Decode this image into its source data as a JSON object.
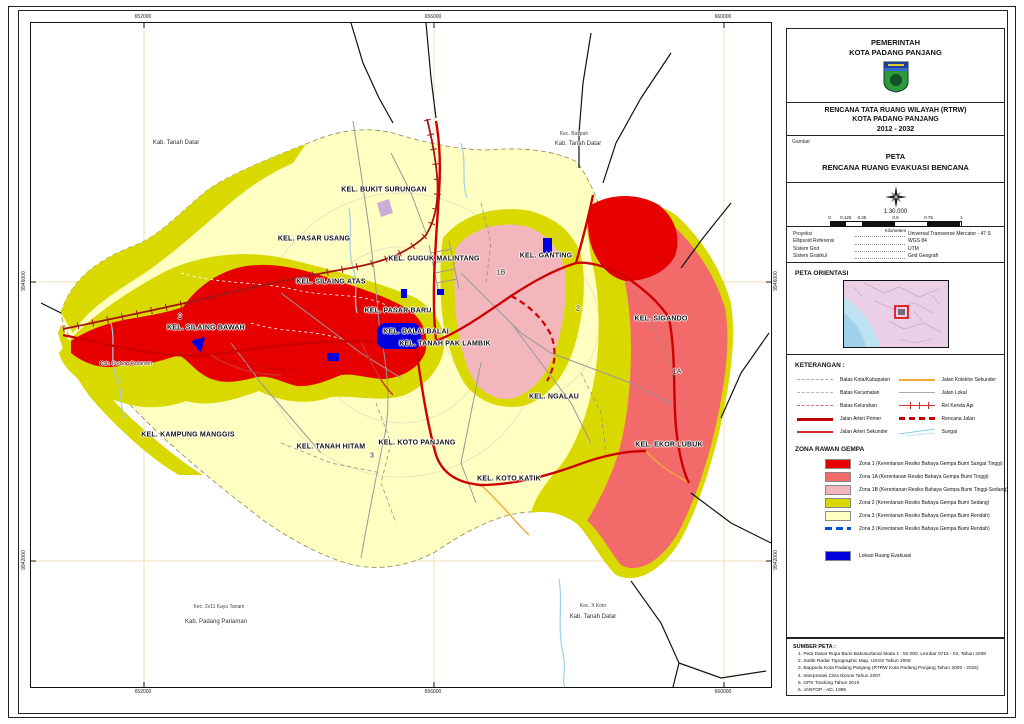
{
  "colors": {
    "zona1": "#e60000",
    "zona1a": "#f26a6a",
    "zona1b": "#f3b6bc",
    "zona2": "#d9d900",
    "zona3": "#ffffc2",
    "evakuasi": "#0000dd",
    "road_primary": "#cf0000",
    "rail": "#a51414",
    "water": "#9fd0e8",
    "grid_line": "#f2ddb5"
  },
  "map": {
    "labels": [
      {
        "t": "Kab. Tanah Datar",
        "x": 145,
        "y": 120,
        "cls": "sm"
      },
      {
        "t": "Kec. Batipuh",
        "x": 543,
        "y": 111,
        "cls": "xs"
      },
      {
        "t": "Kab. Tanah Datar",
        "x": 547,
        "y": 121,
        "cls": "sm"
      },
      {
        "t": "KEL. BUKIT SURUNGAN",
        "x": 353,
        "y": 167,
        "cls": "kel"
      },
      {
        "t": "KEL. PASAR USANG",
        "x": 283,
        "y": 216,
        "cls": "kel"
      },
      {
        "t": "KEL. GUGUK MALINTANG",
        "x": 403,
        "y": 236,
        "cls": "kel"
      },
      {
        "t": "KEL. GANTING",
        "x": 515,
        "y": 233,
        "cls": "kel"
      },
      {
        "t": "1B",
        "x": 470,
        "y": 250,
        "cls": "zn"
      },
      {
        "t": "KEL. SILAING ATAS",
        "x": 300,
        "y": 259,
        "cls": "kel"
      },
      {
        "t": "KEL. PASAR BARU",
        "x": 367,
        "y": 288,
        "cls": "kel"
      },
      {
        "t": "2",
        "x": 547,
        "y": 286,
        "cls": "zn"
      },
      {
        "t": "2",
        "x": 149,
        "y": 294,
        "cls": "zn"
      },
      {
        "t": "KEL. SILAING BAWAH",
        "x": 175,
        "y": 305,
        "cls": "kel"
      },
      {
        "t": "KEL. BALAI BALAI",
        "x": 385,
        "y": 309,
        "cls": "kel"
      },
      {
        "t": "KEL. TANAH PAK LAMBIK",
        "x": 414,
        "y": 321,
        "cls": "kel"
      },
      {
        "t": "KEL. SIGANDO",
        "x": 630,
        "y": 296,
        "cls": "kel"
      },
      {
        "t": "Kab. Padang Pariaman",
        "x": 95,
        "y": 341,
        "cls": "xs"
      },
      {
        "t": "1A",
        "x": 646,
        "y": 349,
        "cls": "zn"
      },
      {
        "t": "KEL. NGALAU",
        "x": 523,
        "y": 374,
        "cls": "kel"
      },
      {
        "t": "KEL. KAMPUNG MANGGIS",
        "x": 157,
        "y": 412,
        "cls": "kel"
      },
      {
        "t": "KEL. KOTO PANJANG",
        "x": 386,
        "y": 420,
        "cls": "kel"
      },
      {
        "t": "KEL. TANAH HITAM",
        "x": 300,
        "y": 424,
        "cls": "kel"
      },
      {
        "t": "KEL. EKOR LUBUK",
        "x": 638,
        "y": 422,
        "cls": "kel"
      },
      {
        "t": "3",
        "x": 341,
        "y": 433,
        "cls": "zn"
      },
      {
        "t": "KEL. KOTO KATIK",
        "x": 478,
        "y": 456,
        "cls": "kel"
      },
      {
        "t": "Kec. 2x11 Kayu Tanam",
        "x": 188,
        "y": 584,
        "cls": "xs"
      },
      {
        "t": "Kab. Padang Pariaman",
        "x": 185,
        "y": 599,
        "cls": "sm"
      },
      {
        "t": "Kec. X Koto",
        "x": 562,
        "y": 583,
        "cls": "xs"
      },
      {
        "t": "Kab. Tanah Datar",
        "x": 562,
        "y": 594,
        "cls": "sm"
      }
    ],
    "grid": {
      "top": [
        {
          "t": "652000",
          "x": 113
        },
        {
          "t": "656000",
          "x": 403
        },
        {
          "t": "660000",
          "x": 693
        }
      ],
      "bottom": [
        {
          "t": "652000",
          "x": 113
        },
        {
          "t": "656000",
          "x": 403
        },
        {
          "t": "660000",
          "x": 693
        }
      ],
      "left": [
        {
          "t": "9946000",
          "y": 259
        },
        {
          "t": "9942000",
          "y": 538
        }
      ],
      "right": [
        {
          "t": "9946000",
          "y": 259
        },
        {
          "t": "9942000",
          "y": 538
        }
      ]
    }
  },
  "panel": {
    "header": {
      "line1": "PEMERINTAH",
      "line2": "KOTA PADANG PANJANG"
    },
    "rtrw": {
      "line1": "RENCANA TATA RUANG WILAYAH (RTRW)",
      "line2": "KOTA PADANG PANJANG",
      "line3": "2012 - 2032"
    },
    "gambar": {
      "label": "Gambar",
      "line1": "PETA",
      "line2": "RENCANA RUANG EVAKUASI BENCANA"
    },
    "scale": {
      "ratio": "1:30.000",
      "ticks": [
        "0",
        "0.125",
        "0.25",
        "0.5",
        "0.75",
        "1"
      ],
      "unit": "Kilometers"
    },
    "projection": {
      "rows": [
        {
          "label": "Proyeksi",
          "value": "Universal Transverse Mercator - 47 S"
        },
        {
          "label": "Ellipsoid Referensi",
          "value": "WGS 84"
        },
        {
          "label": "Sistem Grid",
          "value": "UTM"
        },
        {
          "label": "Sistem Gratikul",
          "value": "Grid Geografi"
        }
      ]
    },
    "orientasi": {
      "title": "PETA ORIENTASI"
    },
    "keterangan": {
      "title": "KETERANGAN :",
      "left": [
        {
          "label": "Batas Kota/Kabupaten",
          "style": "batas-kota"
        },
        {
          "label": "Batas Kecamatan",
          "style": "batas-kec"
        },
        {
          "label": "Batas Kelurahan",
          "style": "batas-kel"
        },
        {
          "label": "Jalan Arteri Primer",
          "style": "arteri-primer"
        },
        {
          "label": "Jalan Arteri Sekunder",
          "style": "arteri-sekunder"
        }
      ],
      "right": [
        {
          "label": "Jalan Kolektor Sekunder",
          "style": "kolektor"
        },
        {
          "label": "Jalan Lokal",
          "style": "lokal"
        },
        {
          "label": "Rel Kereta Api",
          "style": "rel"
        },
        {
          "label": "Rencana Jalan",
          "style": "rencana"
        },
        {
          "label": "Sungai",
          "style": "sungai"
        }
      ]
    },
    "zona": {
      "title": "ZONA RAWAN GEMPA",
      "items": [
        {
          "label": "Zona 1 (Kerentanan Resiko Bahaya Gempa Bumi Sangat Tinggi)",
          "swatch": "#e60000",
          "type": "fill"
        },
        {
          "label": "Zona 1A (Kerentanan Resiko Bahaya Gempa Bumi Tinggi)",
          "swatch": "#f26a6a",
          "type": "fill"
        },
        {
          "label": "Zona 1B (Kerentanan Resiko Bahaya Gempa Bumi Tinggi-Sedang)",
          "swatch": "#f3b6bc",
          "type": "fill"
        },
        {
          "label": "Zona 2 (Kerentanan Resiko Bahaya Gempa Bumi Sedang)",
          "swatch": "#d9d900",
          "type": "fill"
        },
        {
          "label": "Zona 3 (Kerentanan Resiko Bahaya Gempa Bumi Rendah)",
          "swatch": "#ffffc2",
          "type": "fill"
        },
        {
          "label": "Zona 3 (Kerentanan Resiko Bahaya Gempa Bumi Rendah)",
          "swatch": "#0050d0",
          "type": "line"
        },
        {
          "label": "Lokasi Ruang Evakuasi",
          "swatch": "#0000dd",
          "type": "fill",
          "gap": true
        }
      ]
    },
    "sumber": {
      "title": "SUMBER PETA :",
      "items": [
        "1. Peta Dasar Rupa Bumi Bakosurtanal Skala 1 : 50.000, Lembar 0715 - 02, Tahun 2008",
        "2. Suttle Radar Topographic Map, USGS Tahun 2008",
        "3. Bappeda Kota Padang Panjang (RTRW Kota Padang Panjang Tahun 2005 - 2015)",
        "4. Interpretasi Citra Ikonos Tahun 2007",
        "5. GPS Tracking Tahun 2010",
        "6. JANTOP - AD, 1989"
      ]
    }
  }
}
